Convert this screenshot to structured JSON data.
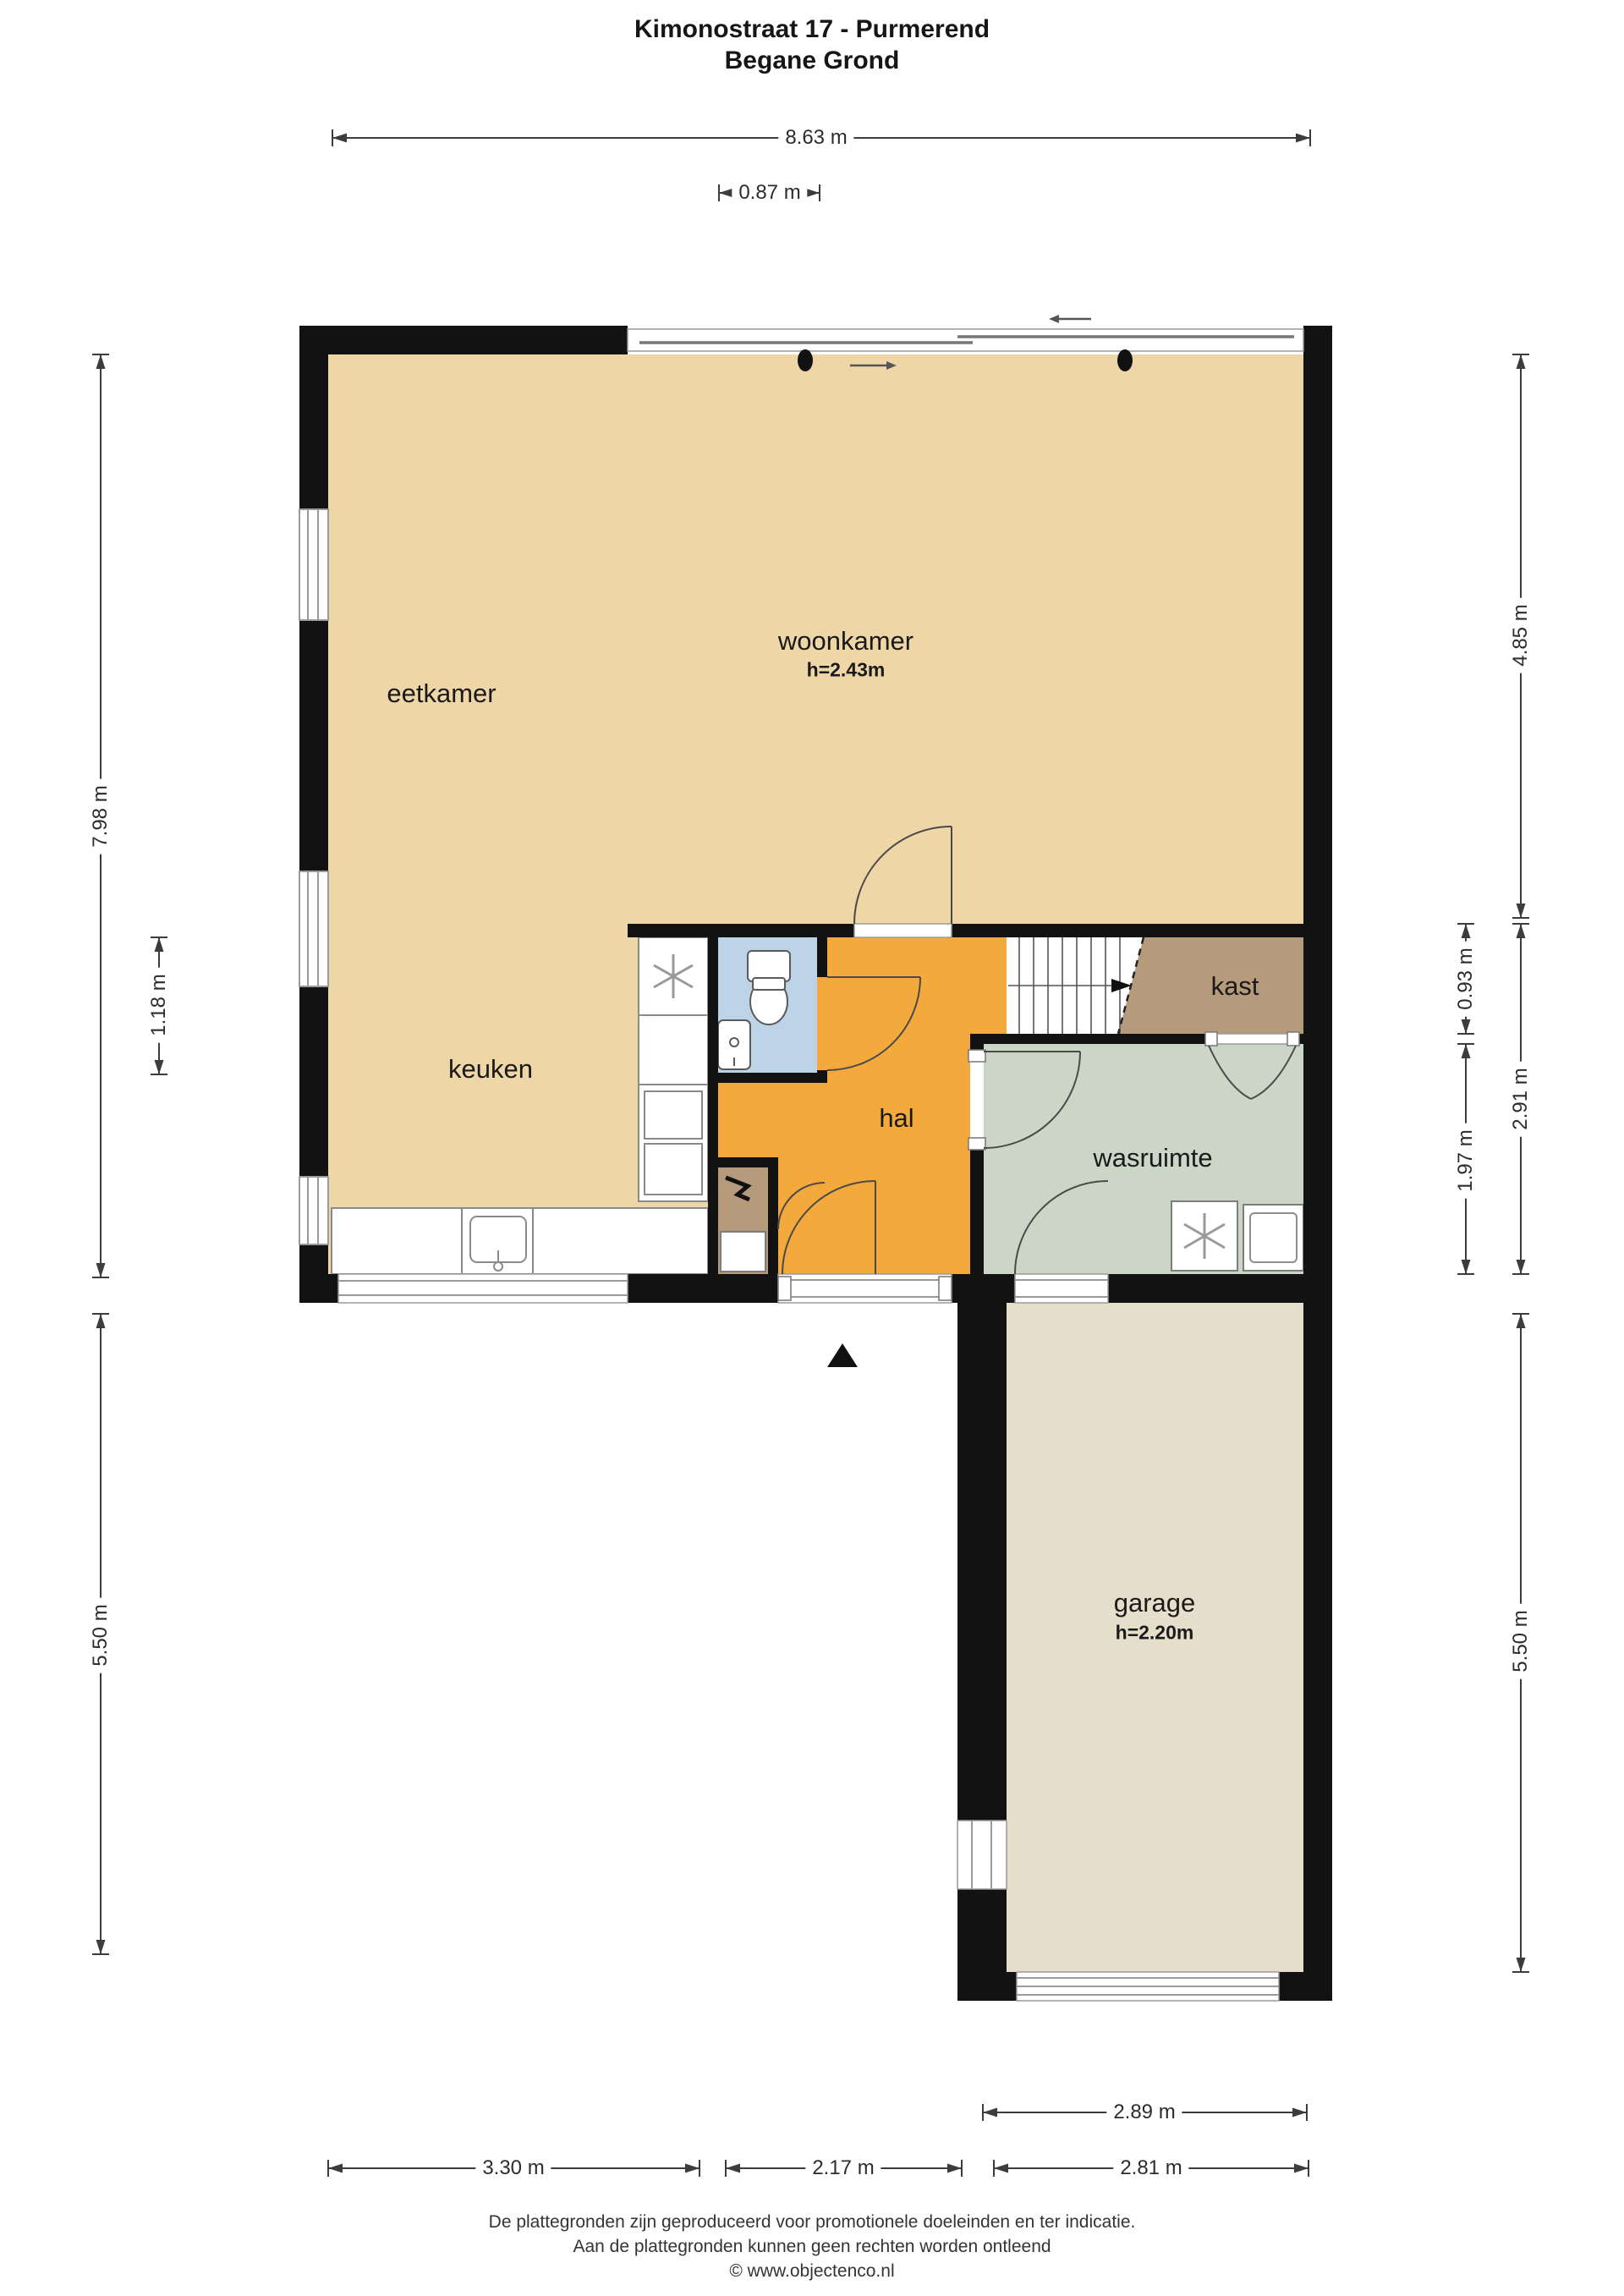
{
  "title": {
    "line1": "Kimonostraat 17 - Purmerend",
    "line2": "Begane Grond"
  },
  "rooms": {
    "woonkamer": {
      "label": "woonkamer",
      "ceiling": "h=2.43m"
    },
    "eetkamer": {
      "label": "eetkamer"
    },
    "keuken": {
      "label": "keuken"
    },
    "hal": {
      "label": "hal"
    },
    "kast": {
      "label": "kast"
    },
    "wasruimte": {
      "label": "wasruimte"
    },
    "garage": {
      "label": "garage",
      "ceiling": "h=2.20m"
    }
  },
  "dimensions": {
    "top_total": "8.63 m",
    "top_slider": "0.87 m",
    "left_upper": "7.98 m",
    "left_keuken": "1.18 m",
    "left_lower": "5.50 m",
    "right_upper": "4.85 m",
    "right_kast": "0.93 m",
    "right_wasruimte": "1.97 m",
    "right_middle": "2.91 m",
    "right_lower": "5.50 m",
    "bottom_garage": "2.89 m",
    "bottom_left": "3.30 m",
    "bottom_center": "2.17 m",
    "bottom_right": "2.81 m"
  },
  "footer": {
    "line1": "De plattegronden zijn geproduceerd voor promotionele doeleinden en ter indicatie.",
    "line2": "Aan de plattegronden kunnen geen rechten worden ontleend",
    "line3": "© www.objectenco.nl"
  },
  "colors": {
    "wall": "#121212",
    "floor": "#efd6a7",
    "hal": "#f4a93d",
    "toilet": "#bdd3e8",
    "kast": "#b59b7c",
    "wasruimte": "#ccd6c7",
    "garage": "#e4decb",
    "dim": "#3c3c3c"
  }
}
